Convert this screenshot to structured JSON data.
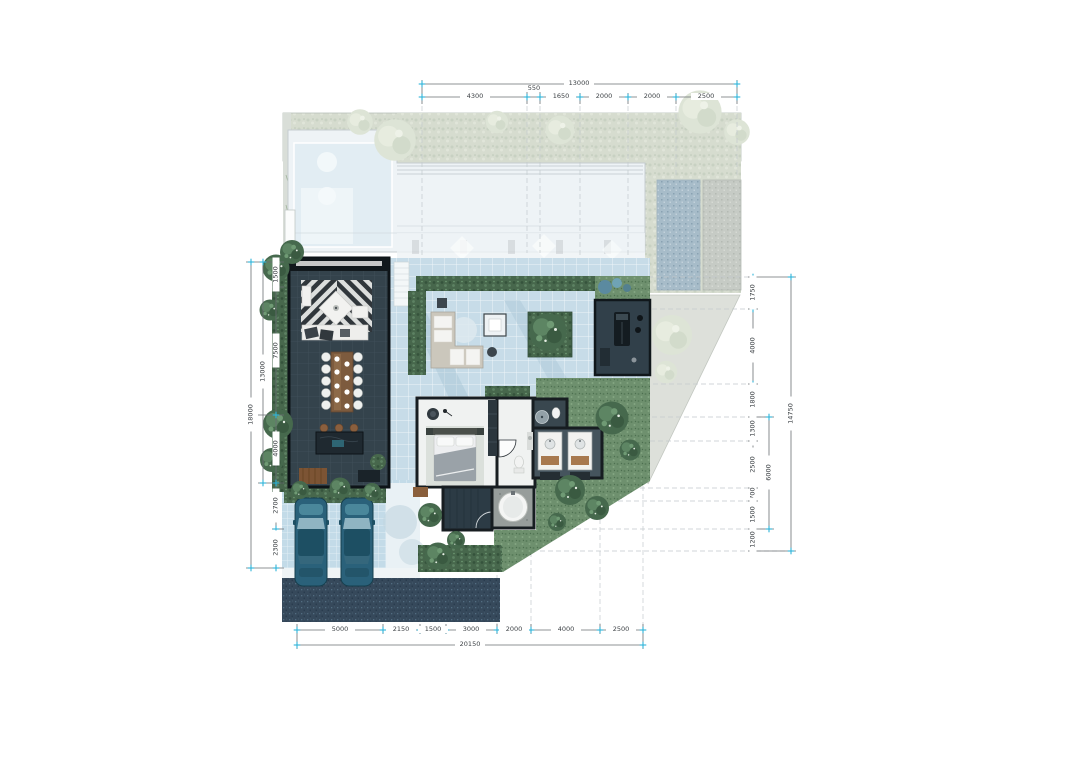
{
  "plan": {
    "dims_top": {
      "total": "13000",
      "segments": [
        "4300",
        "550",
        "1650",
        "2000",
        "2000",
        "2500"
      ]
    },
    "dims_bottom": {
      "total": "20150",
      "segments": [
        "5000",
        "2150",
        "1500",
        "3000",
        "2000",
        "4000",
        "2500"
      ]
    },
    "dims_left": {
      "outer": "18000",
      "inner": "13000",
      "segments": [
        "1500",
        "7500",
        "4000",
        "2700",
        "2300"
      ]
    },
    "dims_right": {
      "outer": "14750",
      "inner": "6000",
      "segments": [
        "1750",
        "4000",
        "1800",
        "1300",
        "2500",
        "700",
        "1500",
        "1200"
      ]
    },
    "colors": {
      "tick_accent": "#2fb3d9",
      "dim_line": "#6a6f73",
      "terrace_tile_blue": "#c7dce8",
      "carport_tile_blue": "#c3dbe8",
      "dark_room": "#33424b",
      "lawn_green": "#6e906e",
      "hedge_green": "#47674c",
      "sage_band": "#d6dccf",
      "paved_triangle_grey": "#dde0da",
      "driveway_dark": "#36495b",
      "car_teal": "#2a617a",
      "wood_brown": "#7d5b3e"
    }
  }
}
